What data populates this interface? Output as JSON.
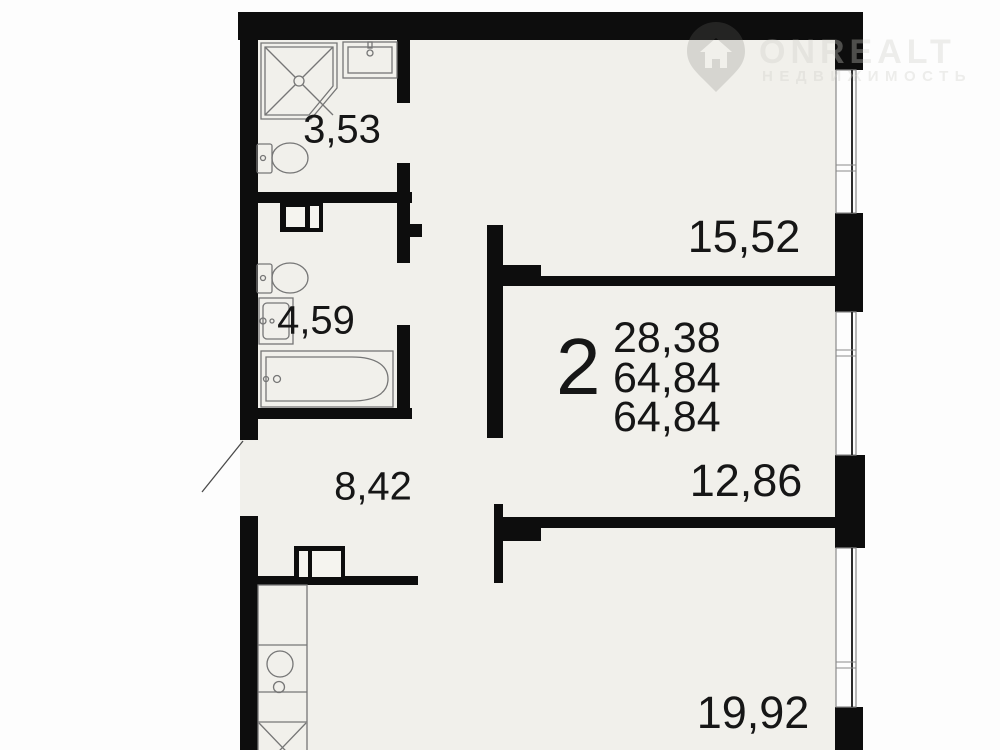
{
  "plan": {
    "apartment_summary": {
      "rooms_count": "2",
      "areas": [
        "28,38",
        "64,84",
        "64,84"
      ]
    },
    "rooms": [
      {
        "name": "shower-bathroom",
        "area": "3,53"
      },
      {
        "name": "bathroom",
        "area": "4,59"
      },
      {
        "name": "hallway",
        "area": "8,42"
      },
      {
        "name": "living-room-top",
        "area": "15,52"
      },
      {
        "name": "room-middle",
        "area": "12,86"
      },
      {
        "name": "kitchen-living-room",
        "area": "19,92"
      }
    ]
  },
  "watermark": {
    "brand": "ONREALT",
    "tagline": "НЕДВИЖИМОСТЬ"
  },
  "colors": {
    "wall": "#0d0d0d",
    "floor": "#f1f0eb",
    "background": "#fdfdfd",
    "fixture_line": "#767676",
    "label_text": "#161616"
  }
}
